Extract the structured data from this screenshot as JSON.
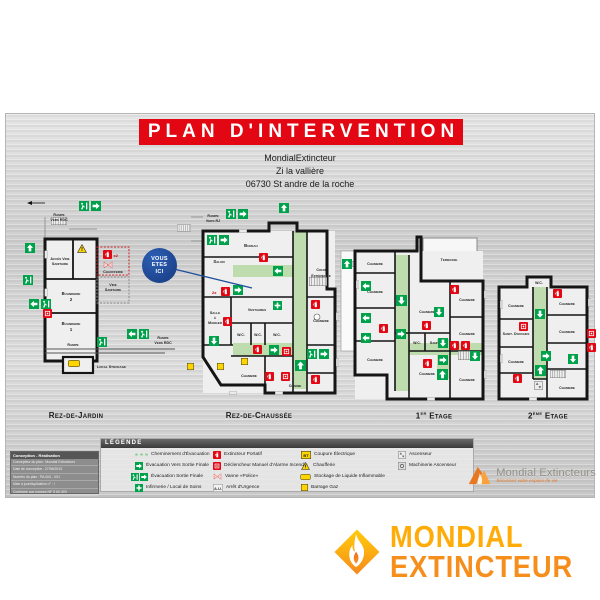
{
  "panel": {
    "title": "PLAN D'INTERVENTION",
    "address_line1": "MondialExtincteur",
    "address_line2": "Zi la vallière",
    "address_line3": "06730 St andre de la roche"
  },
  "marker": {
    "l1": "VOUS",
    "l2": "ETES",
    "l3": "ICI"
  },
  "plans": {
    "rdj": {
      "label": "Rez-de-Jardin",
      "ext_count": "x2",
      "rooms": [
        "Rampe",
        "Vers RDC",
        "Accès Vide",
        "Sanitaire",
        "Chaufferie",
        "Vide",
        "Sanitaire",
        "Buanderie",
        "2",
        "Buanderie",
        "1",
        "Rampe",
        "Local Stockage",
        "Rampe",
        "Vers RDC"
      ]
    },
    "rdc": {
      "label": "Rez-de-Chaussée",
      "ext_count": "2x",
      "rooms": [
        "Rampe",
        "Vers RJ",
        "Bureau",
        "Salon",
        "Salle",
        "à",
        "Manger",
        "Vestiaires",
        "W.C.",
        "W.C.",
        "W.C.",
        "Chambre",
        "Cour",
        "Extérieure",
        "Chambre",
        "Cuisine"
      ]
    },
    "e1": {
      "label_num": "1",
      "label_sup": "er",
      "label_rest": "Etage",
      "rooms": [
        "Chambre",
        "Terrasse",
        "Chambre",
        "Chambre",
        "Chambre",
        "Chambre",
        "W.C.",
        "Sanit.",
        "Chambre",
        "Chambre",
        "Chambre"
      ]
    },
    "e2": {
      "label_num": "2",
      "label_sup": "ème",
      "label_rest": "Etage",
      "rooms": [
        "W.C.",
        "Chambre",
        "Chambre",
        "Sanit. Douches",
        "Chambre",
        "Chambre",
        "Chambre"
      ]
    }
  },
  "legend": {
    "header": "LÉGENDE",
    "items": [
      {
        "icon": "evacuation-path-icon",
        "label": "Cheminement d'Évacuation"
      },
      {
        "icon": "green-arrow-icon",
        "label": "Évacuation Vers Sortie Finale"
      },
      {
        "icon": "final-exit-icon",
        "label": "Évacuation Sortie Finale"
      },
      {
        "icon": "first-aid-icon",
        "label": "Infirmerie / Local de Soins"
      },
      {
        "icon": "extinguisher-icon",
        "label": "Extincteur Portatif"
      },
      {
        "icon": "fire-alarm-icon",
        "label": "Déclencheur Manuel d'Alarme Incendie"
      },
      {
        "icon": "police-valve-icon",
        "label": "Vanne «Police»"
      },
      {
        "icon": "emergency-stop-icon",
        "label": "Arrêt d'Urgence",
        "icon_text": "A.U."
      },
      {
        "icon": "power-cut-icon",
        "label": "Coupure Électrique",
        "icon_text": "BT"
      },
      {
        "icon": "boiler-warning-icon",
        "label": "Chaufferie"
      },
      {
        "icon": "flammable-storage-icon",
        "label": "Stockage de Liquide Inflammable"
      },
      {
        "icon": "gas-shutoff-icon",
        "label": "Barrage Gaz"
      },
      {
        "icon": "elevator-icon",
        "label": "Ascenseur"
      },
      {
        "icon": "elevator-machinery-icon",
        "label": "Machinerie Ascenseur"
      }
    ]
  },
  "cartouche": {
    "header": "Conception - Réalisation",
    "line1": "Concepteur du plan : Mondial Extincteurs",
    "line2": "Date de conception : 27/06/2013",
    "line3": "Numéro du plan : PA-004 - V01",
    "line4": "Mise à jour/duplication n° : /",
    "line5": "Conforme aux normes NF S 60-303"
  },
  "brand_panel": {
    "name": "Mondial Extincteurs",
    "tagline": "Sécurisez votre espace de vie"
  },
  "brand_footer": {
    "line1": "MONDIAL",
    "line2": "EXTINCTEUR"
  }
}
